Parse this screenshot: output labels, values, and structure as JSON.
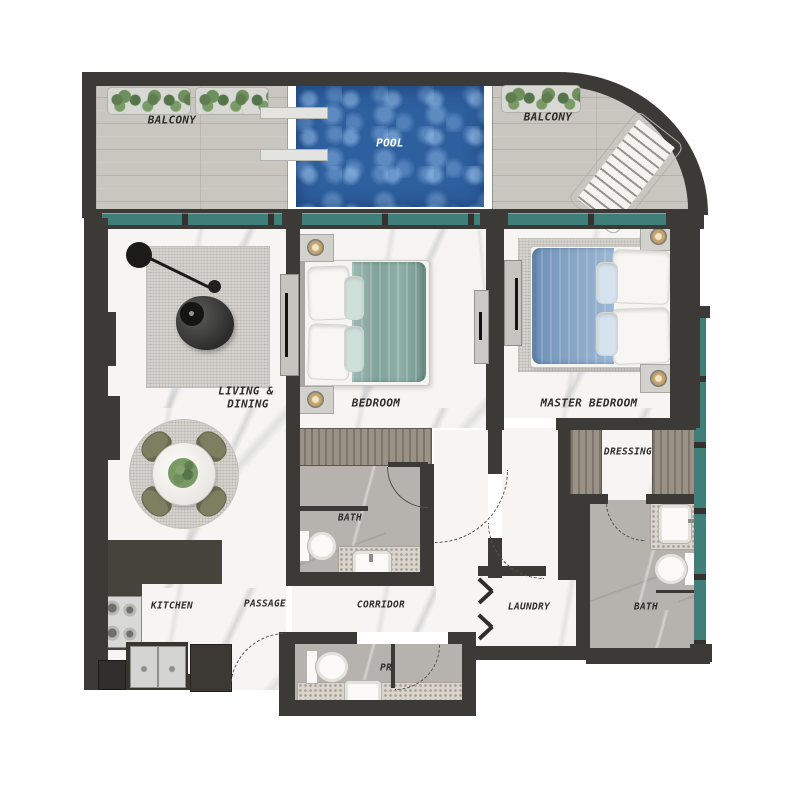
{
  "plan": {
    "type": "apartment-floor-plan",
    "labels": {
      "balcony_left": "BALCONY",
      "balcony_right": "BALCONY",
      "pool": "POOL",
      "living_dining_line1": "LIVING &",
      "living_dining_line2": "DINING",
      "bedroom": "BEDROOM",
      "master_bedroom": "MASTER BEDROOM",
      "bedroom_bath": "BATH",
      "dressing": "DRESSING",
      "master_bath": "BATH",
      "kitchen": "KITCHEN",
      "passage": "PASSAGE",
      "corridor": "CORRIDOR",
      "laundry": "LAUNDRY",
      "powder_room": "PR"
    },
    "colors": {
      "wall": "#3b3a37",
      "window_glass": "#3f7e79",
      "pool_water": "#2e5f9e",
      "deck_wood": "#c9c6bf",
      "marble_floor": "#f6f5f3",
      "bath_tile": "#b6b3ae",
      "kitchen_counter": "#46423c",
      "plant_green": "#6f8f5c",
      "dining_chair_olive": "#7d8060",
      "bed_blanket_teal": "#85a89f",
      "master_blanket_blue": "#85a3c4",
      "rug_gray": "#d5d3cd",
      "wardrobe_wood": "#9b9287"
    }
  }
}
